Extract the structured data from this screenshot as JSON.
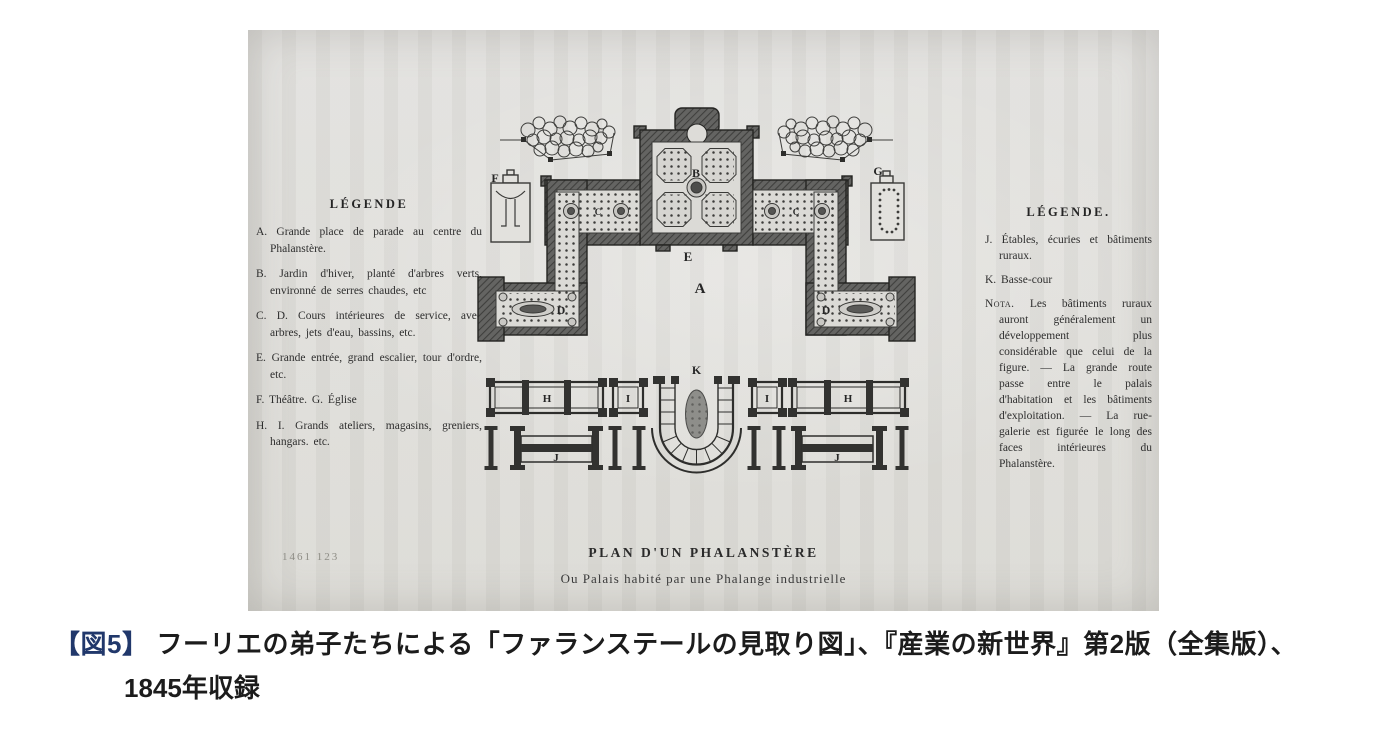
{
  "scan": {
    "legend_left": {
      "title": "LÉGENDE",
      "items": [
        "A. Grande place de parade au centre du Phalanstère.",
        "B. Jardin d'hiver, planté d'arbres verts, environné de serres chaudes, etc",
        "C. D. Cours intérieures de service, avec arbres, jets d'eau, bassins, etc.",
        "E. Grande entrée, grand escalier, tour d'ordre, etc.",
        "F. Théâtre. G. Église",
        "H. I. Grands ateliers, magasins, greniers, hangars. etc."
      ]
    },
    "legend_right": {
      "title": "LÉGENDE.",
      "items": [
        "J. Étables, écuries et bâtiments ruraux.",
        "K. Basse-cour"
      ],
      "nota_label": "Nota.",
      "nota_text": "Les bâtiments ruraux auront généralement un développement plus considérable que celui de la figure. — La grande route passe entre le palais d'habitation et les bâtiments d'exploitation. — La rue-galerie est figurée le long des faces intérieures du Phalanstère."
    },
    "plan_labels": {
      "A": "A",
      "B": "B",
      "C": "C",
      "D": "D",
      "E": "E",
      "F": "F",
      "G": "G",
      "H": "H",
      "I": "I",
      "J": "J",
      "K": "K"
    },
    "plan_title": "PLAN D'UN PHALANSTÈRE",
    "plan_subtitle": "Ou Palais habité par une Phalange industrielle",
    "page_mark": "1461 123"
  },
  "caption": {
    "tag": "【図5】",
    "tag_color": "#21386b",
    "line1": "フーリエの弟子たちによる「ファランステールの見取り図」、『産業の新世界』第2版（全集版）、",
    "line2": "1845年収録"
  }
}
